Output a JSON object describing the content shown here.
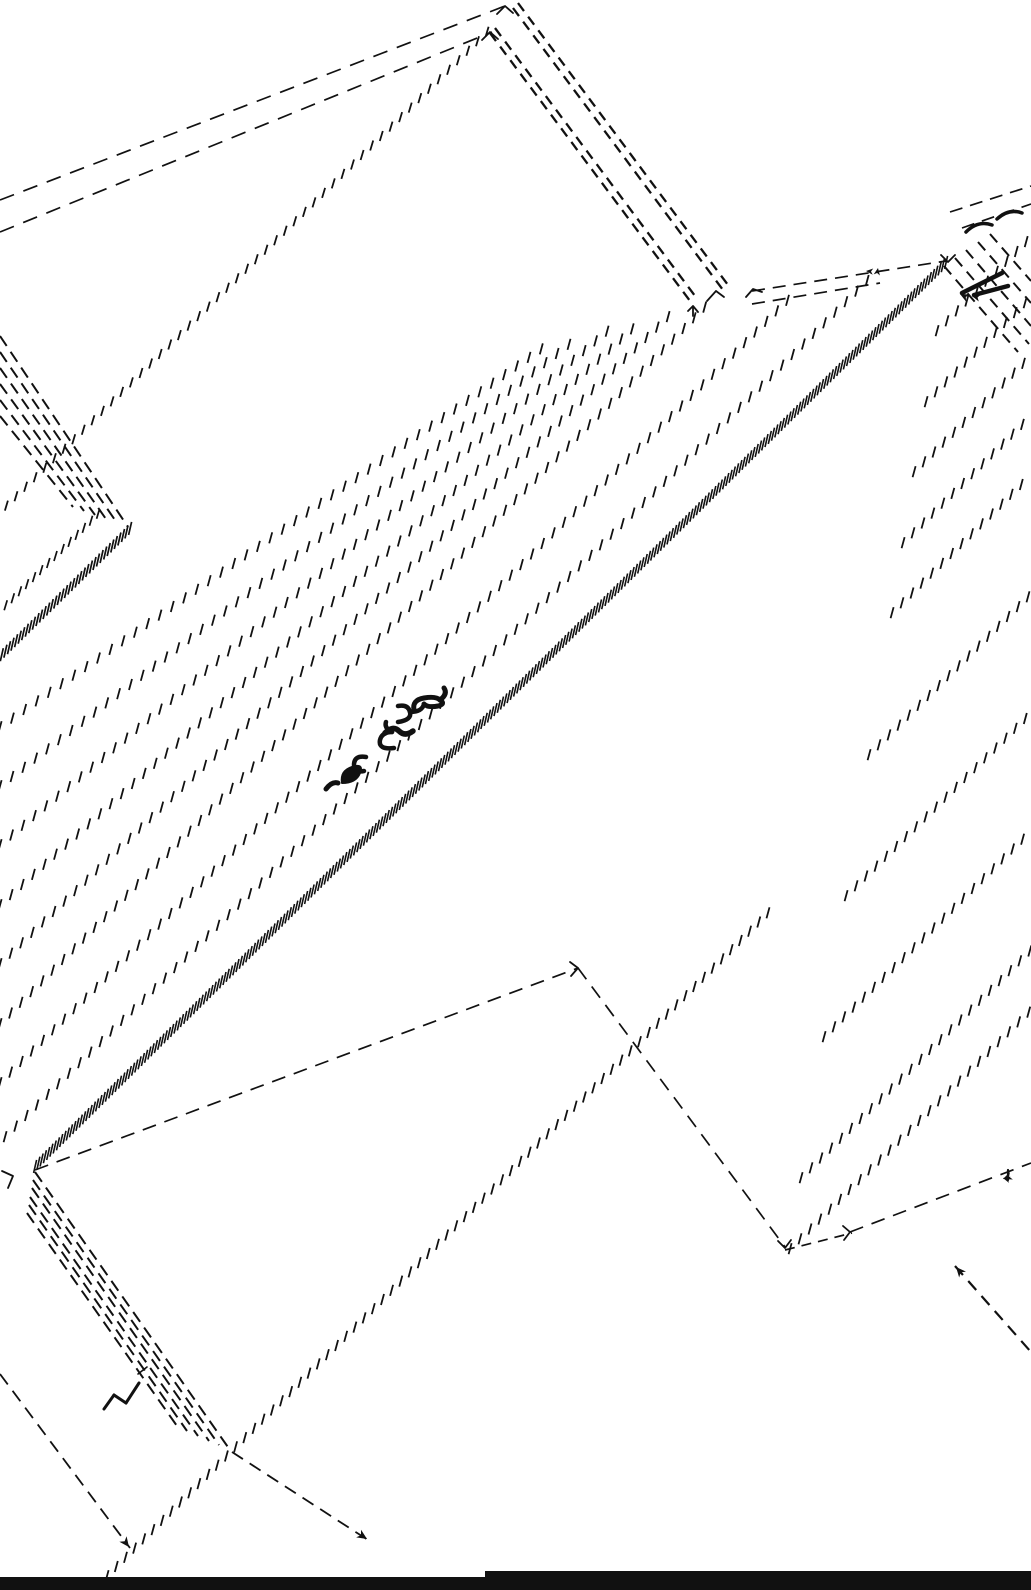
{
  "page": {
    "width": 1031,
    "height": 1590,
    "background": "#ffffff",
    "ink": "#111111"
  },
  "drawing": {
    "description": "hand-drawn axonometric architectural sketch, hatched ink line work",
    "tick_rows": [
      {
        "x1": 487,
        "y1": 33,
        "x2": 0,
        "y2": 513,
        "gap": 13.5,
        "len": 10,
        "w": 1.8
      },
      {
        "x1": 130,
        "y1": 530,
        "x2": 0,
        "y2": 658,
        "gap": 5,
        "len": 13,
        "w": 1.7
      },
      {
        "x1": 98,
        "y1": 515,
        "x2": 0,
        "y2": 612,
        "gap": 10,
        "len": 10,
        "w": 1.7
      },
      {
        "x1": 35,
        "y1": 1168,
        "x2": 948,
        "y2": 262,
        "gap": 4.6,
        "len": 13,
        "w": 1.6
      },
      {
        "x1": 5,
        "y1": 1138,
        "x2": 870,
        "y2": 279,
        "gap": 15,
        "len": 11,
        "w": 1.8
      },
      {
        "x1": 0,
        "y1": 1084,
        "x2": 793,
        "y2": 296,
        "gap": 15,
        "len": 11,
        "w": 1.8
      },
      {
        "x1": 0,
        "y1": 1025,
        "x2": 705,
        "y2": 308,
        "gap": 15,
        "len": 11,
        "w": 1.8
      },
      {
        "x1": 0,
        "y1": 965,
        "x2": 670,
        "y2": 316,
        "gap": 15,
        "len": 11,
        "w": 1.8
      },
      {
        "x1": 0,
        "y1": 906,
        "x2": 640,
        "y2": 323,
        "gap": 15,
        "len": 11,
        "w": 1.8
      },
      {
        "x1": 0,
        "y1": 846,
        "x2": 610,
        "y2": 330,
        "gap": 15,
        "len": 11,
        "w": 1.8
      },
      {
        "x1": 0,
        "y1": 787,
        "x2": 580,
        "y2": 337,
        "gap": 15,
        "len": 11,
        "w": 1.8
      },
      {
        "x1": 0,
        "y1": 728,
        "x2": 550,
        "y2": 344,
        "gap": 15,
        "len": 11,
        "w": 1.8
      },
      {
        "x1": 107,
        "y1": 1577,
        "x2": 770,
        "y2": 912,
        "gap": 13,
        "len": 11,
        "w": 1.8
      },
      {
        "x1": 937,
        "y1": 332,
        "x2": 1031,
        "y2": 238,
        "gap": 14,
        "len": 11,
        "w": 1.8
      },
      {
        "x1": 926,
        "y1": 403,
        "x2": 1031,
        "y2": 298,
        "gap": 14,
        "len": 11,
        "w": 1.8
      },
      {
        "x1": 914,
        "y1": 473,
        "x2": 1031,
        "y2": 357,
        "gap": 14,
        "len": 11,
        "w": 1.8
      },
      {
        "x1": 903,
        "y1": 544,
        "x2": 1031,
        "y2": 417,
        "gap": 14,
        "len": 11,
        "w": 1.8
      },
      {
        "x1": 892,
        "y1": 614,
        "x2": 1031,
        "y2": 476,
        "gap": 14,
        "len": 11,
        "w": 1.8
      },
      {
        "x1": 869,
        "y1": 756,
        "x2": 1031,
        "y2": 595,
        "gap": 14,
        "len": 11,
        "w": 1.8
      },
      {
        "x1": 846,
        "y1": 897,
        "x2": 1031,
        "y2": 714,
        "gap": 14,
        "len": 11,
        "w": 1.8
      },
      {
        "x1": 824,
        "y1": 1038,
        "x2": 1031,
        "y2": 832,
        "gap": 14,
        "len": 11,
        "w": 1.8
      },
      {
        "x1": 801,
        "y1": 1179,
        "x2": 1031,
        "y2": 951,
        "gap": 14,
        "len": 11,
        "w": 1.8
      },
      {
        "x1": 790,
        "y1": 1250,
        "x2": 1031,
        "y2": 1011,
        "gap": 14,
        "len": 11,
        "w": 1.8
      }
    ],
    "dashed_lines": [
      {
        "x1": 0,
        "y1": 200,
        "x2": 505,
        "y2": 6,
        "w": 1.7,
        "dash": "15 10"
      },
      {
        "x1": 0,
        "y1": 232,
        "x2": 492,
        "y2": 32,
        "w": 1.7,
        "dash": "15 10"
      },
      {
        "x1": 513,
        "y1": 8,
        "x2": 723,
        "y2": 290,
        "w": 2.3,
        "dash": "10 7"
      },
      {
        "x1": 518,
        "y1": 3,
        "x2": 728,
        "y2": 285,
        "w": 2.3,
        "dash": "10 7"
      },
      {
        "x1": 490,
        "y1": 33,
        "x2": 693,
        "y2": 305,
        "w": 2.3,
        "dash": "10 7"
      },
      {
        "x1": 495,
        "y1": 28,
        "x2": 698,
        "y2": 300,
        "w": 2.3,
        "dash": "10 7"
      },
      {
        "x1": 0,
        "y1": 336,
        "x2": 128,
        "y2": 527,
        "w": 2,
        "dash": "12 7"
      },
      {
        "x1": 0,
        "y1": 352,
        "x2": 117,
        "y2": 523,
        "w": 2,
        "dash": "12 7"
      },
      {
        "x1": 0,
        "y1": 368,
        "x2": 106,
        "y2": 519,
        "w": 2,
        "dash": "12 7"
      },
      {
        "x1": 0,
        "y1": 384,
        "x2": 95,
        "y2": 515,
        "w": 2,
        "dash": "12 7"
      },
      {
        "x1": 0,
        "y1": 400,
        "x2": 84,
        "y2": 511,
        "w": 2,
        "dash": "12 7"
      },
      {
        "x1": 0,
        "y1": 416,
        "x2": 73,
        "y2": 507,
        "w": 2,
        "dash": "12 7"
      },
      {
        "x1": 35,
        "y1": 1170,
        "x2": 578,
        "y2": 968,
        "w": 1.7,
        "dash": "14 9"
      },
      {
        "x1": 578,
        "y1": 968,
        "x2": 785,
        "y2": 1247,
        "w": 1.7,
        "dash": "14 9"
      },
      {
        "x1": 785,
        "y1": 1250,
        "x2": 852,
        "y2": 1233,
        "w": 1.7,
        "dash": "10 7"
      },
      {
        "x1": 850,
        "y1": 1232,
        "x2": 1031,
        "y2": 1163,
        "w": 1.7,
        "dash": "14 9"
      },
      {
        "x1": 752,
        "y1": 291,
        "x2": 946,
        "y2": 261,
        "w": 1.7,
        "dash": "13 8"
      },
      {
        "x1": 752,
        "y1": 304,
        "x2": 880,
        "y2": 283,
        "w": 1.7,
        "dash": "13 8"
      },
      {
        "x1": 0,
        "y1": 1374,
        "x2": 130,
        "y2": 1548,
        "w": 1.8,
        "dash": "13 8"
      },
      {
        "x1": 232,
        "y1": 1452,
        "x2": 368,
        "y2": 1540,
        "w": 1.8,
        "dash": "13 8"
      },
      {
        "x1": 955,
        "y1": 1266,
        "x2": 1031,
        "y2": 1352,
        "w": 2.2,
        "dash": "12 8"
      },
      {
        "x1": 35,
        "y1": 1172,
        "x2": 230,
        "y2": 1450,
        "w": 2,
        "dash": "12 7"
      },
      {
        "x1": 33,
        "y1": 1180,
        "x2": 219,
        "y2": 1445,
        "w": 2,
        "dash": "12 7"
      },
      {
        "x1": 32,
        "y1": 1188,
        "x2": 209,
        "y2": 1441,
        "w": 2,
        "dash": "12 7"
      },
      {
        "x1": 30,
        "y1": 1197,
        "x2": 198,
        "y2": 1436,
        "w": 2,
        "dash": "12 7"
      },
      {
        "x1": 29,
        "y1": 1205,
        "x2": 187,
        "y2": 1431,
        "w": 2,
        "dash": "12 7"
      },
      {
        "x1": 27,
        "y1": 1213,
        "x2": 177,
        "y2": 1426,
        "w": 2,
        "dash": "12 7"
      },
      {
        "x1": 944,
        "y1": 266,
        "x2": 1018,
        "y2": 352,
        "w": 2,
        "dash": "11 7"
      },
      {
        "x1": 955,
        "y1": 258,
        "x2": 1029,
        "y2": 344,
        "w": 2,
        "dash": "11 7"
      },
      {
        "x1": 966,
        "y1": 250,
        "x2": 1031,
        "y2": 326,
        "w": 2,
        "dash": "11 7"
      },
      {
        "x1": 978,
        "y1": 242,
        "x2": 1031,
        "y2": 303,
        "w": 2,
        "dash": "11 7"
      },
      {
        "x1": 990,
        "y1": 234,
        "x2": 1031,
        "y2": 281,
        "w": 2,
        "dash": "11 7"
      },
      {
        "x1": 950,
        "y1": 212,
        "x2": 1031,
        "y2": 186,
        "w": 1.7,
        "dash": "13 8"
      },
      {
        "x1": 962,
        "y1": 228,
        "x2": 1031,
        "y2": 204,
        "w": 1.7,
        "dash": "13 8"
      }
    ],
    "solid_paths": [
      {
        "d": "M497,14 L505,6 L513,13",
        "w": 1.8
      },
      {
        "d": "M482,40 L490,32 L498,39",
        "w": 1.8
      },
      {
        "d": "M707,301 L716,291 L724,297",
        "w": 1.8
      },
      {
        "d": "M688,311 L693,306 L698,312 M693,306 L693,316",
        "w": 1.8
      },
      {
        "d": "M746,297 L753,289 L762,292",
        "w": 1.8
      },
      {
        "d": "M2,1171 L13,1176 L8,1188",
        "w": 1.8
      },
      {
        "d": "M570,962 L578,968 L571,976",
        "w": 1.8
      },
      {
        "d": "M778,1241 L785,1248 L791,1240",
        "w": 1.8
      },
      {
        "d": "M843,1226 L850,1232 L844,1240",
        "w": 1.8
      },
      {
        "d": "M941,255 L948,262 L955,255",
        "w": 1.8
      },
      {
        "d": "M966,232 Q978,220 992,225",
        "w": 3.5
      },
      {
        "d": "M997,219 Q1009,208 1022,213",
        "w": 3.5
      },
      {
        "d": "M962,293 L1002,273",
        "w": 4.5
      },
      {
        "d": "M974,295 L1008,286",
        "w": 4.5
      },
      {
        "d": "M1008,1170 L1008,1180",
        "w": 2.2
      },
      {
        "d": "M104,1409 L114,1395",
        "w": 3
      },
      {
        "d": "M114,1395 L126,1403",
        "w": 3
      },
      {
        "d": "M126,1403 L139,1383",
        "w": 3
      },
      {
        "d": "M138,1374 L147,1367",
        "w": 1.6
      }
    ],
    "arrowheads": [
      {
        "x": 129,
        "y": 1547,
        "angle": 53,
        "size": 10
      },
      {
        "x": 367,
        "y": 1539,
        "angle": 33,
        "size": 10
      },
      {
        "x": 956,
        "y": 1267,
        "angle": 229,
        "size": 10
      },
      {
        "x": 1003,
        "y": 1179,
        "angle": 159,
        "size": 9
      },
      {
        "x": 960,
        "y": 294,
        "angle": 207,
        "size": 9
      },
      {
        "x": 972,
        "y": 296,
        "angle": 195,
        "size": 8
      },
      {
        "x": 878,
        "y": 268,
        "angle": -80,
        "size": 7
      },
      {
        "x": 866,
        "y": 271,
        "angle": 185,
        "size": 7
      },
      {
        "x": 1003,
        "y": 1178,
        "angle": 195,
        "size": 7
      }
    ],
    "signature": {
      "note": "illegible handwritten inscription, drawn diagonally",
      "stroke_paths": [
        {
          "d": "M326,789 Q332,781 338,783",
          "w": 5
        },
        {
          "d": "M342,783 Q340,771 352,767 Q364,763 360,773 Q356,783 342,783 Z",
          "w": 2,
          "fill": true
        },
        {
          "d": "M366,757 Q354,755 354,765 Q354,773 364,771",
          "w": 4.5
        },
        {
          "d": "M394,748 Q378,750 380,740 Q382,732 392,732",
          "w": 4.5
        },
        {
          "d": "M392,732 Q384,728 386,722",
          "w": 4.5
        },
        {
          "d": "M385,733 Q393,725 399,731 Q405,737 413,731",
          "w": 5.5
        },
        {
          "d": "M398,722 Q412,720 410,712 Q408,704 398,706",
          "w": 4.5
        },
        {
          "d": "M410,712 Q422,712 424,704",
          "w": 4.5
        },
        {
          "d": "M414,710 Q412,700 424,698 Q436,696 440,700 Q446,704 438,706 Q428,708 424,704",
          "w": 5
        },
        {
          "d": "M440,700 Q448,694 444,688",
          "w": 5
        }
      ]
    },
    "bars": [
      {
        "x": 0,
        "y": 1577,
        "w": 1031,
        "h": 13
      },
      {
        "x": 485,
        "y": 1571,
        "w": 546,
        "h": 7
      }
    ]
  }
}
